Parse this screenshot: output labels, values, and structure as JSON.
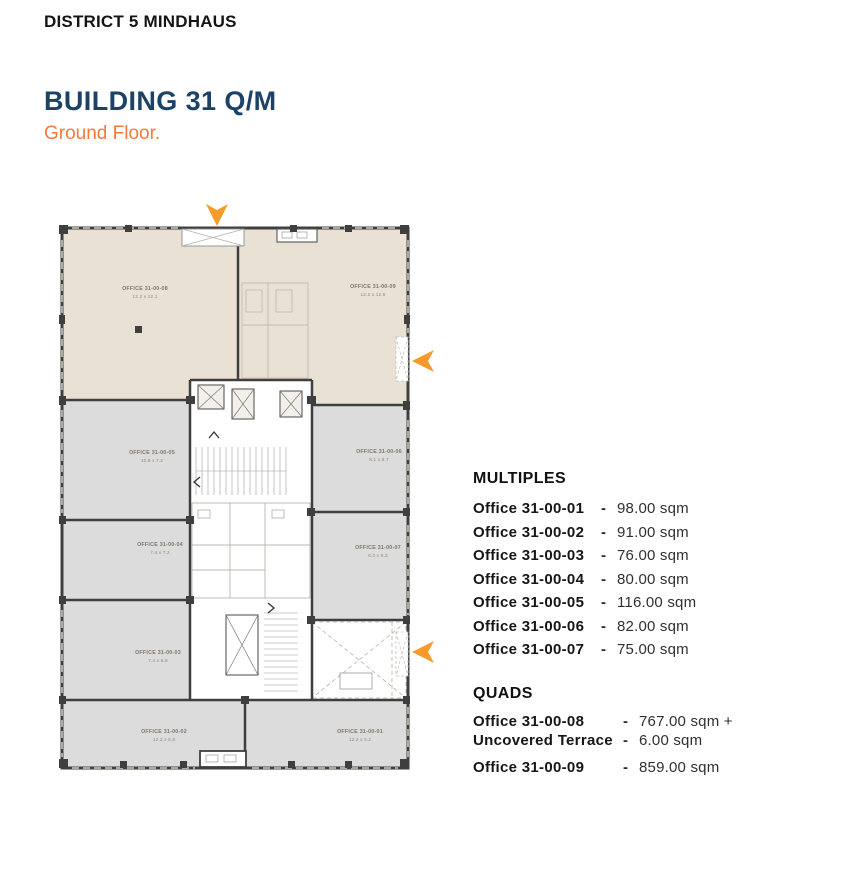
{
  "header": {
    "project": "DISTRICT 5 MINDHAUS",
    "building": "BUILDING 31 Q/M",
    "floor": "Ground Floor."
  },
  "colors": {
    "navy": "#1C4267",
    "accent_orange": "#F4793B",
    "arrow_orange": "#F59A2B",
    "beige_room": "#E9E1D3",
    "gray_room": "#DCDCDC",
    "wall": "#3F3F3F"
  },
  "plan": {
    "arrows": [
      "entrance-arrow-down",
      "side-entrance-arrow-left-upper",
      "side-entrance-arrow-left-lower"
    ],
    "rooms": [
      {
        "name": "OFFICE 31-00-08",
        "dims": "12.2 x 12.1"
      },
      {
        "name": "OFFICE 31-00-09",
        "dims": "12.2 x 12.5"
      },
      {
        "name": "OFFICE 31-00-05",
        "dims": "10.8 x 7.2"
      },
      {
        "name": "OFFICE 31-00-06",
        "dims": "8.1 x 5.7"
      },
      {
        "name": "OFFICE 31-00-04",
        "dims": "7.4 x 7.2"
      },
      {
        "name": "OFFICE 31-00-07",
        "dims": "6.2 x 9.3"
      },
      {
        "name": "OFFICE 31-00-03",
        "dims": "7.4 x 6.8"
      },
      {
        "name": "OFFICE 31-00-02",
        "dims": "12.2 x 5.8"
      },
      {
        "name": "OFFICE 31-00-01",
        "dims": "12.2 x 5.2"
      }
    ]
  },
  "legend": {
    "separator": "-",
    "multiples": {
      "title": "MULTIPLES",
      "items": [
        {
          "name": "Office 31-00-01",
          "area": "98.00 sqm"
        },
        {
          "name": "Office 31-00-02",
          "area": "91.00 sqm"
        },
        {
          "name": "Office 31-00-03",
          "area": "76.00 sqm"
        },
        {
          "name": "Office 31-00-04",
          "area": "80.00 sqm"
        },
        {
          "name": "Office 31-00-05",
          "area": "116.00 sqm"
        },
        {
          "name": "Office 31-00-06",
          "area": "82.00 sqm"
        },
        {
          "name": "Office 31-00-07",
          "area": "75.00 sqm"
        }
      ]
    },
    "quads": {
      "title": "QUADS",
      "items": [
        {
          "name": "Office 31-00-08",
          "area": "767.00 sqm +"
        },
        {
          "name": "Uncovered Terrace",
          "area": "6.00 sqm"
        },
        {
          "name": "Office 31-00-09",
          "area": "859.00 sqm"
        }
      ]
    }
  }
}
